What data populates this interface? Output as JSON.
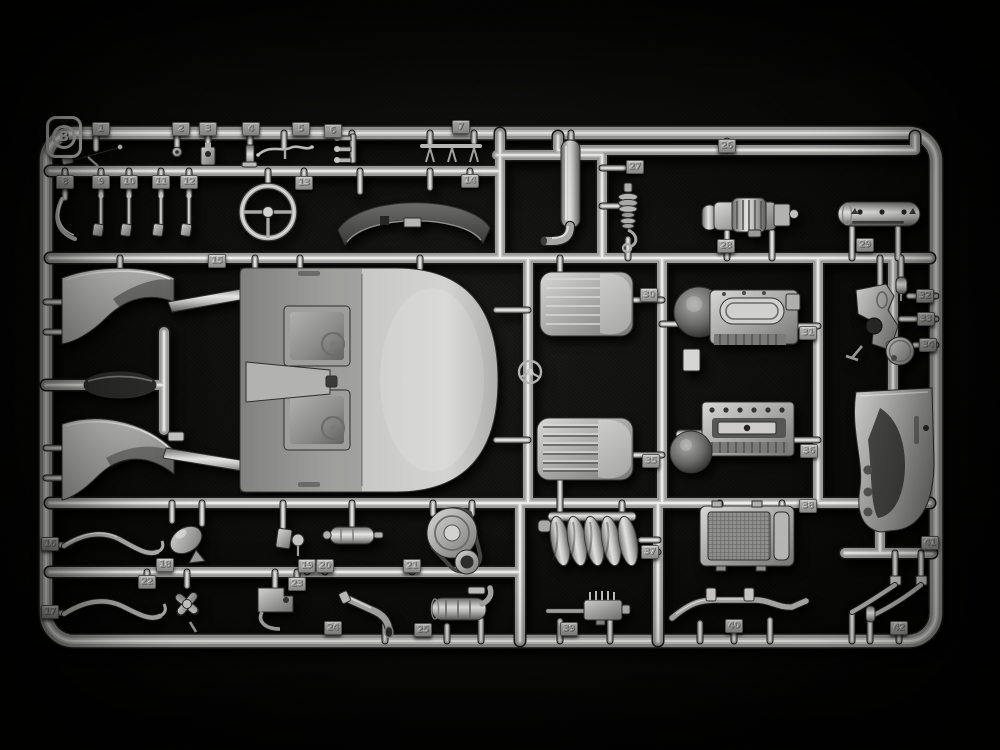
{
  "photo": {
    "subject": "injection-molded model kit parts sprue on dark fabric",
    "sprue_letter": "B",
    "plastic_color": "#b0b0ae",
    "background_color": "#0e0e0c",
    "part_count": 42
  },
  "parts": [
    {
      "number": "1",
      "name": "lever-arm",
      "x": 101,
      "y": 129
    },
    {
      "number": "2",
      "name": "grommet",
      "x": 181,
      "y": 129
    },
    {
      "number": "3",
      "name": "latch-block",
      "x": 208,
      "y": 129
    },
    {
      "number": "4",
      "name": "small-bracket",
      "x": 251,
      "y": 129
    },
    {
      "number": "5",
      "name": "linkage-rod",
      "x": 301,
      "y": 129
    },
    {
      "number": "6",
      "name": "fork-fitting",
      "x": 333,
      "y": 131
    },
    {
      "number": "7",
      "name": "pedal-bar",
      "x": 461,
      "y": 127
    },
    {
      "number": "8",
      "name": "curved-lever",
      "x": 65,
      "y": 182
    },
    {
      "number": "9",
      "name": "pedal-lever",
      "x": 101,
      "y": 182
    },
    {
      "number": "10",
      "name": "pedal-lever",
      "x": 129,
      "y": 182
    },
    {
      "number": "11",
      "name": "pedal-lever",
      "x": 161,
      "y": 182
    },
    {
      "number": "12",
      "name": "pedal-lever",
      "x": 189,
      "y": 182
    },
    {
      "number": "13",
      "name": "steering-wheel",
      "x": 304,
      "y": 183
    },
    {
      "number": "14",
      "name": "dashboard-cowl",
      "x": 470,
      "y": 181
    },
    {
      "number": "15",
      "name": "interior-tub",
      "x": 217,
      "y": 261
    },
    {
      "number": "16",
      "name": "pull-rod",
      "x": 50,
      "y": 544
    },
    {
      "number": "17",
      "name": "pull-rod",
      "x": 50,
      "y": 612
    },
    {
      "number": "18",
      "name": "horn",
      "x": 165,
      "y": 565
    },
    {
      "number": "19",
      "name": "mount-plate",
      "x": 307,
      "y": 566
    },
    {
      "number": "20",
      "name": "starter-motor",
      "x": 325,
      "y": 566
    },
    {
      "number": "21",
      "name": "pulley-assembly",
      "x": 412,
      "y": 566
    },
    {
      "number": "22",
      "name": "cooling-fan",
      "x": 147,
      "y": 582
    },
    {
      "number": "23",
      "name": "bracket-with-hose",
      "x": 297,
      "y": 584
    },
    {
      "number": "24",
      "name": "exhaust-pipe",
      "x": 333,
      "y": 628
    },
    {
      "number": "25",
      "name": "muffler-cylinder",
      "x": 423,
      "y": 630
    },
    {
      "number": "26",
      "name": "long-rod",
      "x": 727,
      "y": 146
    },
    {
      "number": "27",
      "name": "shock-absorber",
      "x": 635,
      "y": 167
    },
    {
      "number": "28",
      "name": "generator",
      "x": 726,
      "y": 246
    },
    {
      "number": "29",
      "name": "perforated-cylinder",
      "x": 865,
      "y": 245
    },
    {
      "number": "30",
      "name": "seat-back",
      "x": 649,
      "y": 295
    },
    {
      "number": "31",
      "name": "engine-block",
      "x": 808,
      "y": 333
    },
    {
      "number": "32",
      "name": "small-cylinder",
      "x": 925,
      "y": 296
    },
    {
      "number": "33",
      "name": "pedal-bracket",
      "x": 926,
      "y": 319
    },
    {
      "number": "34",
      "name": "round-disc",
      "x": 928,
      "y": 345
    },
    {
      "number": "35",
      "name": "seat-back",
      "x": 651,
      "y": 461
    },
    {
      "number": "36",
      "name": "engine-crankcase",
      "x": 809,
      "y": 451
    },
    {
      "number": "37",
      "name": "exhaust-manifold",
      "x": 650,
      "y": 552
    },
    {
      "number": "38",
      "name": "radiator",
      "x": 808,
      "y": 506
    },
    {
      "number": "39",
      "name": "ignition-unit",
      "x": 569,
      "y": 629
    },
    {
      "number": "40",
      "name": "stabilizer-bar",
      "x": 734,
      "y": 626
    },
    {
      "number": "41",
      "name": "firewall-cowl",
      "x": 930,
      "y": 543
    },
    {
      "number": "42",
      "name": "linkage-rods",
      "x": 899,
      "y": 628
    }
  ]
}
